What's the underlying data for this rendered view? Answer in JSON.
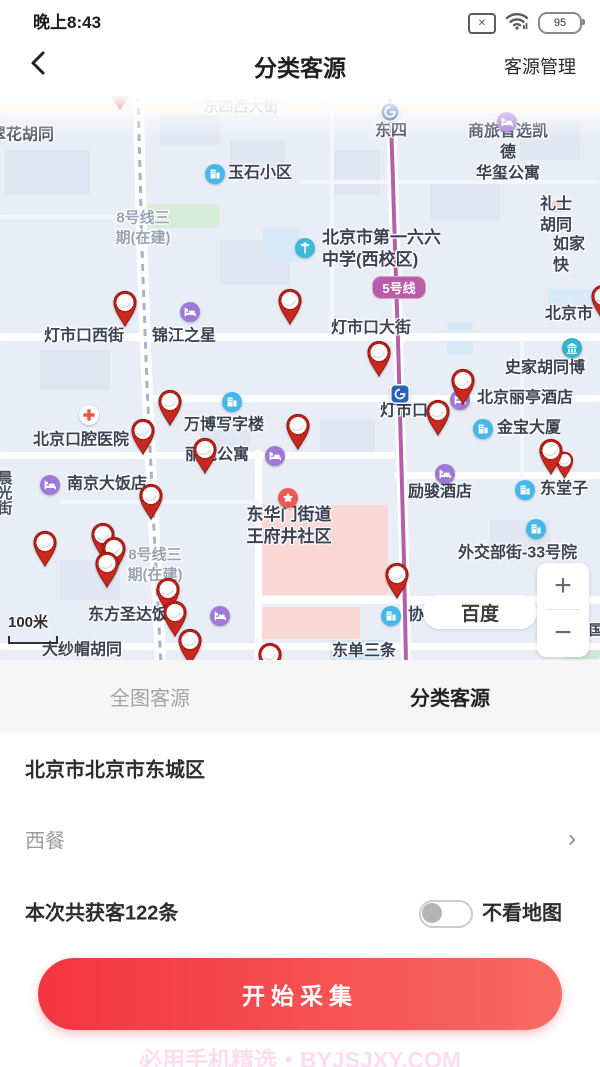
{
  "status_bar": {
    "time": "晚上8:43",
    "battery": "95",
    "sim_glyph": "✕"
  },
  "nav": {
    "title": "分类客源",
    "action": "客源管理"
  },
  "tabs": [
    {
      "label": "全图客源",
      "active": false
    },
    {
      "label": "分类客源",
      "active": true
    }
  ],
  "region_row": {
    "value": "北京市北京市东城区"
  },
  "category_row": {
    "value": "西餐",
    "chevron": "›"
  },
  "result_row": {
    "text": "本次共获客122条",
    "toggle_label": "不看地图",
    "toggle_on": false
  },
  "primary_button": {
    "label": "开始采集"
  },
  "watermark": "必用手机精选・BYJSJXY.COM",
  "map": {
    "attribution": "百度",
    "scale_label": "100米",
    "zoom_in": "+",
    "zoom_out": "−",
    "badge": {
      "text": "5号线",
      "x": 372,
      "y": 181,
      "w": 52
    },
    "colors": {
      "bg": "#e9edf6",
      "pin": "#c9281f",
      "metro5": "#b55fa8",
      "accent_red": "#f4353f"
    },
    "areas": [
      {
        "x": 5,
        "y": 55,
        "w": 85,
        "h": 45,
        "c": "#e0e7f2"
      },
      {
        "x": 160,
        "y": 20,
        "w": 60,
        "h": 30,
        "c": "#e0e7f2"
      },
      {
        "x": 230,
        "y": 45,
        "w": 55,
        "h": 40,
        "c": "#e0e7f2"
      },
      {
        "x": 330,
        "y": 55,
        "w": 50,
        "h": 45,
        "c": "#e0e7f2"
      },
      {
        "x": 430,
        "y": 85,
        "w": 70,
        "h": 40,
        "c": "#e0e7f2"
      },
      {
        "x": 520,
        "y": 25,
        "w": 60,
        "h": 40,
        "c": "#e0e7f2"
      },
      {
        "x": 40,
        "y": 255,
        "w": 70,
        "h": 40,
        "c": "#e0e7f2"
      },
      {
        "x": 200,
        "y": 335,
        "w": 50,
        "h": 30,
        "c": "#e0e7f2"
      },
      {
        "x": 320,
        "y": 325,
        "w": 55,
        "h": 35,
        "c": "#e0e7f2"
      },
      {
        "x": 490,
        "y": 425,
        "w": 60,
        "h": 35,
        "c": "#e0e7f2"
      },
      {
        "x": 60,
        "y": 465,
        "w": 60,
        "h": 40,
        "c": "#e0e7f2"
      },
      {
        "x": 220,
        "y": 145,
        "w": 70,
        "h": 45,
        "c": "#e0e7f2"
      },
      {
        "x": 145,
        "y": 109,
        "w": 75,
        "h": 24,
        "c": "#d5ecd9",
        "r": 8
      },
      {
        "x": 563,
        "y": 548,
        "w": 37,
        "h": 16,
        "c": "#cde8d2",
        "r": 4
      },
      {
        "x": 263,
        "y": 133,
        "w": 37,
        "h": 34,
        "c": "#d8eaf8",
        "r": 3
      },
      {
        "x": 447,
        "y": 227,
        "w": 26,
        "h": 33,
        "c": "#d8eaf8",
        "r": 3
      },
      {
        "x": 548,
        "y": 194,
        "w": 52,
        "h": 18,
        "c": "#d8eaf8",
        "r": 3
      },
      {
        "x": 330,
        "y": 545,
        "w": 55,
        "h": 20,
        "c": "#cfe4f4",
        "r": 2
      },
      {
        "x": 552,
        "y": 106,
        "w": 15,
        "h": 11,
        "c": "#f6c9c5",
        "r": 2
      },
      {
        "x": 262,
        "y": 410,
        "w": 126,
        "h": 90,
        "c": "#f8d7d4",
        "r": 2
      },
      {
        "x": 262,
        "y": 512,
        "w": 98,
        "h": 32,
        "c": "#f8d7d4",
        "r": 2
      }
    ],
    "roads": [
      {
        "x": 0,
        "y": 9,
        "w": 600,
        "h": 9,
        "c": "#f7f2e0"
      },
      {
        "x": 0,
        "y": 238,
        "w": 600,
        "h": 8
      },
      {
        "x": 150,
        "y": 300,
        "w": 450,
        "h": 7
      },
      {
        "x": 0,
        "y": 357,
        "w": 395,
        "h": 7
      },
      {
        "x": 395,
        "y": 377,
        "w": 205,
        "h": 7
      },
      {
        "x": 258,
        "y": 501,
        "w": 342,
        "h": 8
      },
      {
        "x": 0,
        "y": 548,
        "w": 600,
        "h": 7
      },
      {
        "x": 255,
        "y": 355,
        "w": 7,
        "h": 210
      },
      {
        "x": 0,
        "y": 120,
        "w": 135,
        "h": 4,
        "c": "#f3f6fa"
      },
      {
        "x": 300,
        "y": 85,
        "w": 300,
        "h": 4,
        "c": "#f3f6fa"
      },
      {
        "x": 60,
        "y": 405,
        "w": 200,
        "h": 4,
        "c": "#f3f6fa"
      },
      {
        "x": 330,
        "y": 0,
        "w": 4,
        "h": 240,
        "c": "#f3f6fa"
      },
      {
        "x": 520,
        "y": 245,
        "w": 4,
        "h": 140,
        "c": "#f3f6fa"
      }
    ],
    "metro_lines": [
      {
        "name": "line-5",
        "points": "390,0 392,55 396,185 398,245 401,355 404,465 406,570",
        "color": "#b55fa8",
        "w": 4,
        "road_w": 10
      },
      {
        "name": "line-8-construction",
        "points": "138,0 142,155 147,290 153,415 161,570",
        "color": "#a7b2c4",
        "w": 3,
        "road_w": 11,
        "dash": "7 6"
      }
    ],
    "labels": [
      {
        "lines": [
          "东四西大街"
        ],
        "tx": 241,
        "ty": 12,
        "align": "center",
        "size": 15,
        "color": "#aeb6c2"
      },
      {
        "lines": [
          "翠花胡同"
        ],
        "tx": -10,
        "ty": 41,
        "align": "left",
        "size": 16,
        "color": "#465060"
      },
      {
        "icon": "metro",
        "ix": 390,
        "iy": 17,
        "lines": [
          "东四"
        ],
        "tx": 391,
        "ty": 37,
        "align": "center",
        "size": 16
      },
      {
        "icon": "hotel",
        "ix": 507,
        "iy": 27,
        "lines": [
          "商旅智选凯德",
          "华玺公寓"
        ],
        "tx": 508,
        "ty": 58,
        "align": "center",
        "size": 16
      },
      {
        "icon": "community",
        "ix": 215,
        "iy": 79,
        "lines": [
          "玉石小区"
        ],
        "tx": 228,
        "ty": 79,
        "align": "left",
        "size": 16
      },
      {
        "lines": [
          "8号线三",
          "期(在建)"
        ],
        "tx": 143,
        "ty": 133,
        "align": "center",
        "size": 15,
        "color": "#9aa3b2"
      },
      {
        "lines": [
          "礼士胡同"
        ],
        "tx": 556,
        "ty": 121,
        "align": "center",
        "size": 16
      },
      {
        "icon": "school",
        "ix": 305,
        "iy": 153,
        "lines": [
          "北京市第一六六",
          "中学(西校区)"
        ],
        "tx": 322,
        "ty": 154,
        "align": "left",
        "size": 17
      },
      {
        "lines": [
          "如家快"
        ],
        "tx": 553,
        "ty": 161,
        "align": "left",
        "size": 16
      },
      {
        "lines": [
          "北京市"
        ],
        "tx": 545,
        "ty": 220,
        "align": "left",
        "size": 16
      },
      {
        "lines": [
          "灯市口西街"
        ],
        "tx": 84,
        "ty": 242,
        "align": "center",
        "size": 16,
        "color": "#3c4657"
      },
      {
        "icon": "hotel",
        "ix": 190,
        "iy": 217,
        "lines": [
          "锦江之星"
        ],
        "tx": 152,
        "ty": 242,
        "align": "left",
        "size": 16
      },
      {
        "lines": [
          "灯市口大街"
        ],
        "tx": 371,
        "ty": 234,
        "align": "center",
        "size": 16,
        "color": "#3c4657"
      },
      {
        "icon": "museum",
        "ix": 572,
        "iy": 253,
        "lines": [
          "史家胡同博"
        ],
        "tx": 505,
        "ty": 274,
        "align": "left",
        "size": 16
      },
      {
        "icon": "hospital",
        "ix": 89,
        "iy": 320,
        "lines": [
          "北京口腔医院"
        ],
        "tx": 33,
        "ty": 346,
        "align": "left",
        "size": 16
      },
      {
        "icon": "community",
        "ix": 232,
        "iy": 307,
        "lines": [
          "万博写字楼"
        ],
        "tx": 184,
        "ty": 331,
        "align": "left",
        "size": 16
      },
      {
        "icon": "metro2",
        "ix": 400,
        "iy": 299,
        "lines": [
          "灯市口"
        ],
        "tx": 380,
        "ty": 317,
        "align": "left",
        "size": 16
      },
      {
        "icon": "hotel",
        "ix": 460,
        "iy": 305,
        "lines": [
          "北京丽亭酒店"
        ],
        "tx": 477,
        "ty": 304,
        "align": "left",
        "size": 16
      },
      {
        "icon": "community",
        "ix": 483,
        "iy": 334,
        "lines": [
          "金宝大厦"
        ],
        "tx": 497,
        "ty": 334,
        "align": "left",
        "size": 16
      },
      {
        "icon": "hotel",
        "ix": 275,
        "iy": 361,
        "lines": [
          "丽苑公寓"
        ],
        "tx": 185,
        "ty": 361,
        "align": "left",
        "size": 16
      },
      {
        "icon": "hotel",
        "ix": 50,
        "iy": 390,
        "lines": [
          "南京大饭店"
        ],
        "tx": 67,
        "ty": 390,
        "align": "left",
        "size": 16
      },
      {
        "icon": "hotel",
        "ix": 445,
        "iy": 379,
        "lines": [
          "励骏酒店"
        ],
        "tx": 408,
        "ty": 398,
        "align": "left",
        "size": 16
      },
      {
        "icon": "community",
        "ix": 525,
        "iy": 395,
        "lines": [
          "东堂子"
        ],
        "tx": 540,
        "ty": 395,
        "align": "left",
        "size": 16
      },
      {
        "icon": "star",
        "ix": 288,
        "iy": 403,
        "lines": [
          "东华门街道",
          "王府井社区"
        ],
        "tx": 289,
        "ty": 431,
        "align": "center",
        "size": 17
      },
      {
        "icon": "community",
        "ix": 536,
        "iy": 434,
        "lines": [
          "外交部街-33号院"
        ],
        "tx": 458,
        "ty": 459,
        "align": "left",
        "size": 16
      },
      {
        "lines": [
          "晨光街"
        ],
        "tx": -6,
        "ty": 375,
        "vertical": true,
        "size": 15,
        "color": "#465060"
      },
      {
        "icon": "hotel",
        "ix": 220,
        "iy": 521,
        "lines": [
          "东方圣达饭店"
        ],
        "tx": 88,
        "ty": 521,
        "align": "left",
        "size": 16
      },
      {
        "icon": "community",
        "ix": 391,
        "iy": 521,
        "lines": [
          "协"
        ],
        "tx": 408,
        "ty": 521,
        "align": "left",
        "size": 16
      },
      {
        "lines": [
          "大纱帽胡同"
        ],
        "tx": 42,
        "ty": 556,
        "align": "left",
        "size": 16
      },
      {
        "lines": [
          "东单三条"
        ],
        "tx": 332,
        "ty": 557,
        "align": "left",
        "size": 16
      },
      {
        "lines": [
          "国"
        ],
        "tx": 589,
        "ty": 535,
        "align": "left",
        "size": 14
      },
      {
        "lines": [
          "8号线三",
          "期(在建)"
        ],
        "tx": 155,
        "ty": 470,
        "align": "center",
        "size": 15,
        "color": "#9aa3b2"
      }
    ],
    "pins": [
      {
        "x": 120,
        "y": -7
      },
      {
        "x": 603,
        "y": 204
      },
      {
        "x": 125,
        "y": 210
      },
      {
        "x": 290,
        "y": 208
      },
      {
        "x": 379,
        "y": 260
      },
      {
        "x": 463,
        "y": 288
      },
      {
        "x": 170,
        "y": 309
      },
      {
        "x": 438,
        "y": 319
      },
      {
        "x": 298,
        "y": 333
      },
      {
        "x": 143,
        "y": 338
      },
      {
        "x": 205,
        "y": 357
      },
      {
        "x": 564,
        "y": 367,
        "s": 0.75
      },
      {
        "x": 551,
        "y": 358
      },
      {
        "x": 151,
        "y": 403
      },
      {
        "x": 103,
        "y": 442
      },
      {
        "x": 45,
        "y": 450
      },
      {
        "x": 114,
        "y": 456
      },
      {
        "x": 107,
        "y": 471
      },
      {
        "x": 397,
        "y": 482
      },
      {
        "x": 168,
        "y": 497
      },
      {
        "x": 175,
        "y": 520
      },
      {
        "x": 190,
        "y": 548
      },
      {
        "x": 270,
        "y": 562
      }
    ]
  }
}
